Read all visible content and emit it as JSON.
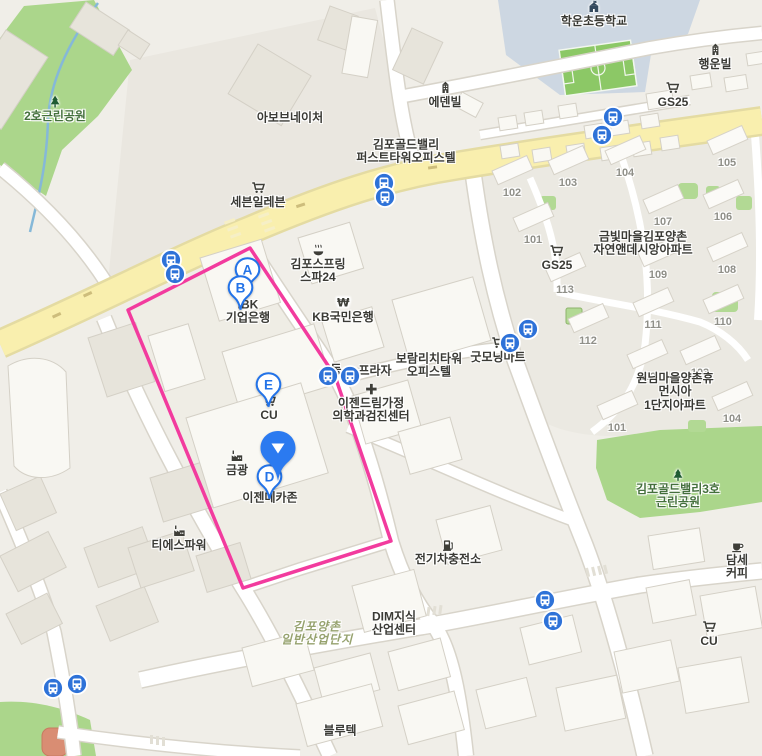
{
  "map": {
    "colors": {
      "background": "#f0eee8",
      "road_yellow": "#f9efae",
      "park_green": "#abd68b",
      "school_ground": "#cdd7e2",
      "field_green": "#8cc866",
      "parcel_pink": "#f23b9e",
      "bus_blue": "#2e72d8",
      "marker_blue": "#2373e8",
      "selected_pin_blue": "#2b7af0",
      "label_dark": "#3a3a35",
      "park_label_green": "#44703c",
      "industry_label_green": "#96a26e",
      "apt_number_gray": "#8f8f88"
    },
    "pois": [
      {
        "name": "poi-park-2ho",
        "icon": "tree-icon",
        "label": "2호근린공원",
        "x": 55,
        "y": 116,
        "cls": "park"
      },
      {
        "name": "poi-abovenature",
        "icon": null,
        "label": "아보브네이처",
        "x": 290,
        "y": 118,
        "cls": ""
      },
      {
        "name": "poi-hakun-elementary",
        "icon": "school-icon",
        "label": "학운초등학교",
        "x": 594,
        "y": 21,
        "cls": ""
      },
      {
        "name": "poi-haengunvil",
        "icon": "building-icon",
        "label": "행운빌",
        "x": 715,
        "y": 64,
        "cls": ""
      },
      {
        "name": "poi-gs25-top",
        "icon": "cart-icon",
        "label": "GS25",
        "x": 673,
        "y": 102,
        "cls": ""
      },
      {
        "name": "poi-edenvil",
        "icon": "building-icon",
        "label": "에덴빌",
        "x": 445,
        "y": 102,
        "cls": ""
      },
      {
        "name": "poi-goldvalley-firsttower",
        "icon": null,
        "label": "김포골드밸리\n퍼스트타워오피스텔",
        "x": 406,
        "y": 152,
        "cls": ""
      },
      {
        "name": "poi-seven-eleven",
        "icon": "cart-icon",
        "label": "세븐일레븐",
        "x": 258,
        "y": 202,
        "cls": ""
      },
      {
        "name": "poi-gimpospring-spa24",
        "icon": "spa-icon",
        "label": "김포스프링\n스파24",
        "x": 318,
        "y": 271,
        "cls": ""
      },
      {
        "name": "poi-ibk-bank",
        "icon": null,
        "label": "IBK\n기업은행",
        "x": 248,
        "y": 312,
        "cls": ""
      },
      {
        "name": "poi-kb-bank",
        "icon": "won-icon",
        "label": "KB국민은행",
        "x": 343,
        "y": 317,
        "cls": ""
      },
      {
        "name": "poi-boram-richtower",
        "icon": null,
        "label": "보람리치타워\n오피스텔",
        "x": 429,
        "y": 366,
        "cls": ""
      },
      {
        "name": "poi-goodmorning-mart",
        "icon": "cart-icon",
        "label": "굿모닝마트",
        "x": 498,
        "y": 357,
        "cls": ""
      },
      {
        "name": "poi-plaza-prefix",
        "icon": null,
        "label": "동",
        "x": 336,
        "y": 370,
        "cls": ""
      },
      {
        "name": "poi-plaza",
        "icon": null,
        "label": "프라자",
        "x": 375,
        "y": 371,
        "cls": ""
      },
      {
        "name": "poi-ezen-dream-clinic",
        "icon": "cross-icon",
        "label": "이젠드림가정\n의학과검진센터",
        "x": 371,
        "y": 410,
        "cls": ""
      },
      {
        "name": "poi-cu-center",
        "icon": "cart-icon",
        "label": "CU",
        "x": 269,
        "y": 415,
        "cls": ""
      },
      {
        "name": "poi-geumgwang",
        "icon": "factory-icon",
        "label": "금광",
        "x": 237,
        "y": 470,
        "cls": ""
      },
      {
        "name": "poi-ezen-mechazone",
        "icon": null,
        "label": "이젠메카존",
        "x": 270,
        "y": 498,
        "cls": ""
      },
      {
        "name": "poi-ts-power",
        "icon": "factory-icon",
        "label": "티에스파워",
        "x": 179,
        "y": 545,
        "cls": ""
      },
      {
        "name": "poi-ev-charging-station",
        "icon": "charger-icon",
        "label": "전기차충전소",
        "x": 448,
        "y": 559,
        "cls": ""
      },
      {
        "name": "poi-dim-knowledge-center",
        "icon": null,
        "label": "DIM지식\n산업센터",
        "x": 394,
        "y": 624,
        "cls": ""
      },
      {
        "name": "poi-gimpo-industrial-complex",
        "icon": null,
        "label": "김포양촌\n일반산업단지",
        "x": 317,
        "y": 634,
        "cls": "ind"
      },
      {
        "name": "poi-blutek",
        "icon": null,
        "label": "블루텍",
        "x": 340,
        "y": 731,
        "cls": ""
      },
      {
        "name": "poi-goldvalley3-park",
        "icon": "tree-icon",
        "label": "김포골드밸리3호\n근린공원",
        "x": 678,
        "y": 496,
        "cls": "park"
      },
      {
        "name": "poi-damse-coffee",
        "icon": "coffee-icon",
        "label": "담세커피",
        "x": 737,
        "y": 567,
        "cls": ""
      },
      {
        "name": "poi-cu-bottom",
        "icon": "cart-icon",
        "label": "CU",
        "x": 709,
        "y": 641,
        "cls": ""
      },
      {
        "name": "poi-wonnim-humansia-apt",
        "icon": null,
        "label": "원님마을양촌휴먼시아\n1단지아파트",
        "x": 675,
        "y": 392,
        "cls": ""
      },
      {
        "name": "poi-geumbit-desian-apt",
        "icon": null,
        "label": "금빛마을김포양촌\n자연앤데시앙아파트",
        "x": 643,
        "y": 244,
        "cls": ""
      },
      {
        "name": "poi-gs25-right",
        "icon": "cart-icon",
        "label": "GS25",
        "x": 557,
        "y": 265,
        "cls": ""
      }
    ],
    "markers": [
      {
        "name": "marker-a",
        "type": "letter",
        "letter": "A",
        "x": 247,
        "y": 269
      },
      {
        "name": "marker-b",
        "type": "letter",
        "letter": "B",
        "x": 240,
        "y": 287
      },
      {
        "name": "marker-e",
        "type": "letter",
        "letter": "E",
        "x": 268,
        "y": 384
      },
      {
        "name": "marker-d",
        "type": "letter",
        "letter": "D",
        "x": 269,
        "y": 476
      },
      {
        "name": "marker-selected",
        "type": "selected",
        "letter": "",
        "x": 278,
        "y": 447
      }
    ],
    "bus_stops": [
      [
        171,
        260
      ],
      [
        175,
        274
      ],
      [
        384,
        183
      ],
      [
        385,
        197
      ],
      [
        602,
        135
      ],
      [
        613,
        117
      ],
      [
        328,
        376
      ],
      [
        350,
        376
      ],
      [
        510,
        343
      ],
      [
        528,
        329
      ],
      [
        545,
        600
      ],
      [
        553,
        621
      ],
      [
        53,
        688
      ],
      [
        77,
        684
      ]
    ],
    "apartment_numbers": [
      {
        "t": "101",
        "x": 533,
        "y": 240
      },
      {
        "t": "102",
        "x": 512,
        "y": 193
      },
      {
        "t": "103",
        "x": 568,
        "y": 183
      },
      {
        "t": "104",
        "x": 625,
        "y": 173
      },
      {
        "t": "105",
        "x": 727,
        "y": 163
      },
      {
        "t": "106",
        "x": 723,
        "y": 217
      },
      {
        "t": "107",
        "x": 663,
        "y": 222
      },
      {
        "t": "108",
        "x": 727,
        "y": 270
      },
      {
        "t": "109",
        "x": 658,
        "y": 275
      },
      {
        "t": "110",
        "x": 723,
        "y": 322
      },
      {
        "t": "111",
        "x": 653,
        "y": 325
      },
      {
        "t": "112",
        "x": 588,
        "y": 341
      },
      {
        "t": "113",
        "x": 565,
        "y": 290
      },
      {
        "t": "101",
        "x": 617,
        "y": 428
      },
      {
        "t": "102",
        "x": 647,
        "y": 377
      },
      {
        "t": "103",
        "x": 700,
        "y": 373
      },
      {
        "t": "104",
        "x": 732,
        "y": 419
      }
    ]
  }
}
